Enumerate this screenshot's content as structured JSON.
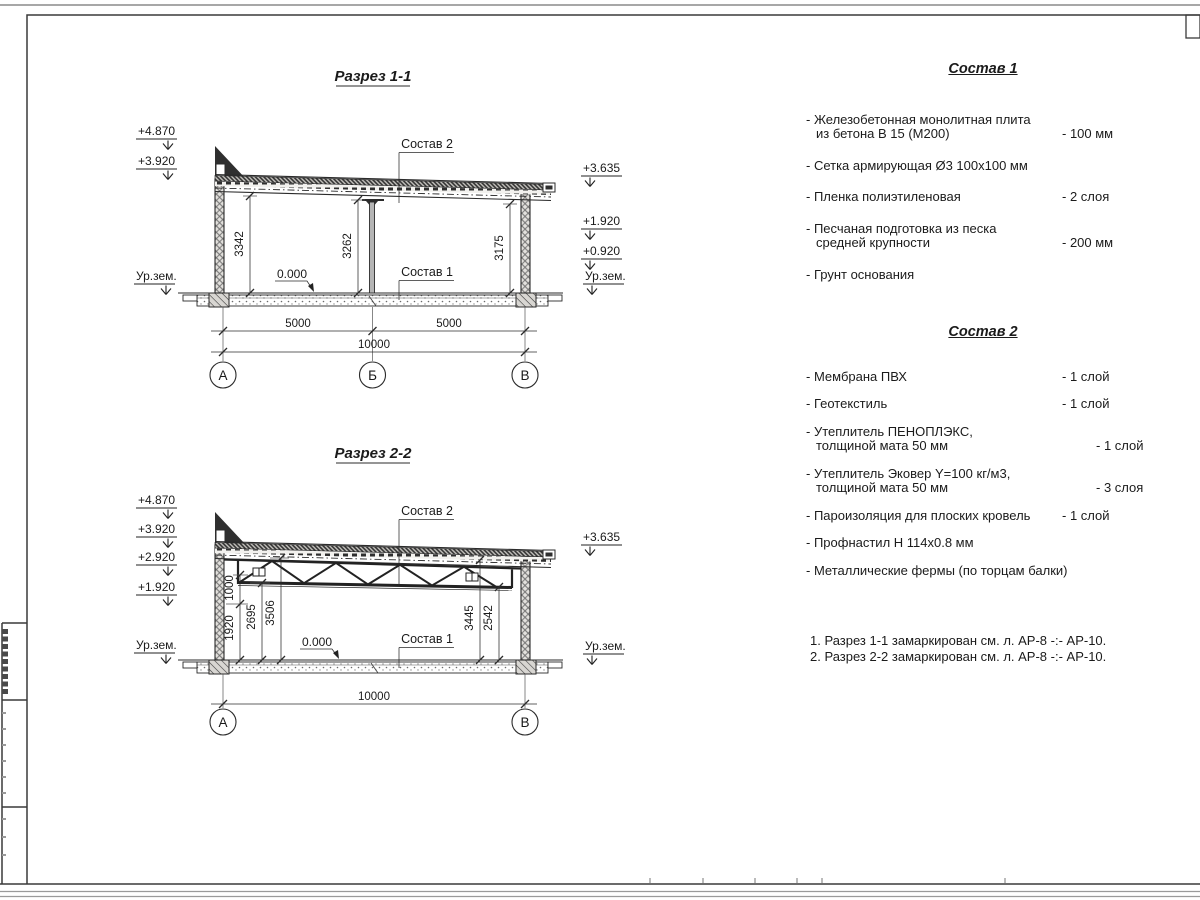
{
  "section1": {
    "title": "Разрез 1-1",
    "labels": {
      "sostav2_ref": "Состав 2",
      "sostav1_ref": "Состав 1",
      "zero": "0.000"
    },
    "elevations_left": [
      "+4.870",
      "+3.920"
    ],
    "ground_left": "Ур.зем.",
    "elevations_right": [
      "+3.635",
      "+1.920",
      "+0.920"
    ],
    "ground_right": "Ур.зем.",
    "dims_vertical": [
      "3342",
      "3262",
      "3175"
    ],
    "dims_bottom": [
      "5000",
      "5000",
      "10000"
    ],
    "grid_axes": [
      "А",
      "Б",
      "В"
    ]
  },
  "section2": {
    "title": "Разрез 2-2",
    "labels": {
      "sostav2_ref": "Состав 2",
      "sostav1_ref": "Состав 1",
      "zero": "0.000"
    },
    "elevations_left": [
      "+4.870",
      "+3.920",
      "+2.920",
      "+1.920"
    ],
    "ground_left": "Ур.зем.",
    "elevations_right": [
      "+3.635"
    ],
    "ground_right": "Ур.зем.",
    "dims_vertical_left": [
      "1000",
      "1920",
      "2695",
      "3506"
    ],
    "dims_vertical_right": [
      "3445",
      "2542"
    ],
    "dim_bottom": "10000",
    "grid_axes": [
      "А",
      "В"
    ]
  },
  "sostav1": {
    "title": "Состав 1",
    "items": [
      {
        "l1": "- Железобетонная  монолитная плита",
        "l2": "из бетона В 15 (М200)",
        "v": "- 100 мм"
      },
      {
        "l1": "- Сетка армирующая Ø3 100x100 мм"
      },
      {
        "l1": "- Пленка полиэтиленовая",
        "v": "- 2 слоя"
      },
      {
        "l1": "- Песчаная подготовка из песка",
        "l2": "средней крупности",
        "v": "- 200 мм"
      },
      {
        "l1": "- Грунт основания"
      }
    ]
  },
  "sostav2": {
    "title": "Состав 2",
    "items": [
      {
        "l1": "- Мембрана ПВХ",
        "v": "- 1 слой"
      },
      {
        "l1": "- Геотекстиль",
        "v": "- 1 слой"
      },
      {
        "l1": "- Утеплитель ПЕНОПЛЭКС,",
        "l2": "толщиной мата 50 мм",
        "v": "- 1 слой"
      },
      {
        "l1": "- Утеплитель Эковер Y=100 кг/м3,",
        "l2": "толщиной мата 50 мм",
        "v": "- 3 слоя"
      },
      {
        "l1": "- Пароизоляция для плоских кровель",
        "v": "- 1 слой"
      },
      {
        "l1": "- Профнастил Н 114x0.8 мм"
      },
      {
        "l1": "- Металлические фермы (по торцам балки)"
      }
    ]
  },
  "notes": [
    "1. Разрез 1-1 замаркирован см. л. АР-8 -:- АР-10.",
    "2. Разрез 2-2 замаркирован см. л. АР-8 -:- АР-10."
  ],
  "colors": {
    "line": "#2b2b2b",
    "text": "#1a1a1a",
    "paper": "#ffffff"
  }
}
